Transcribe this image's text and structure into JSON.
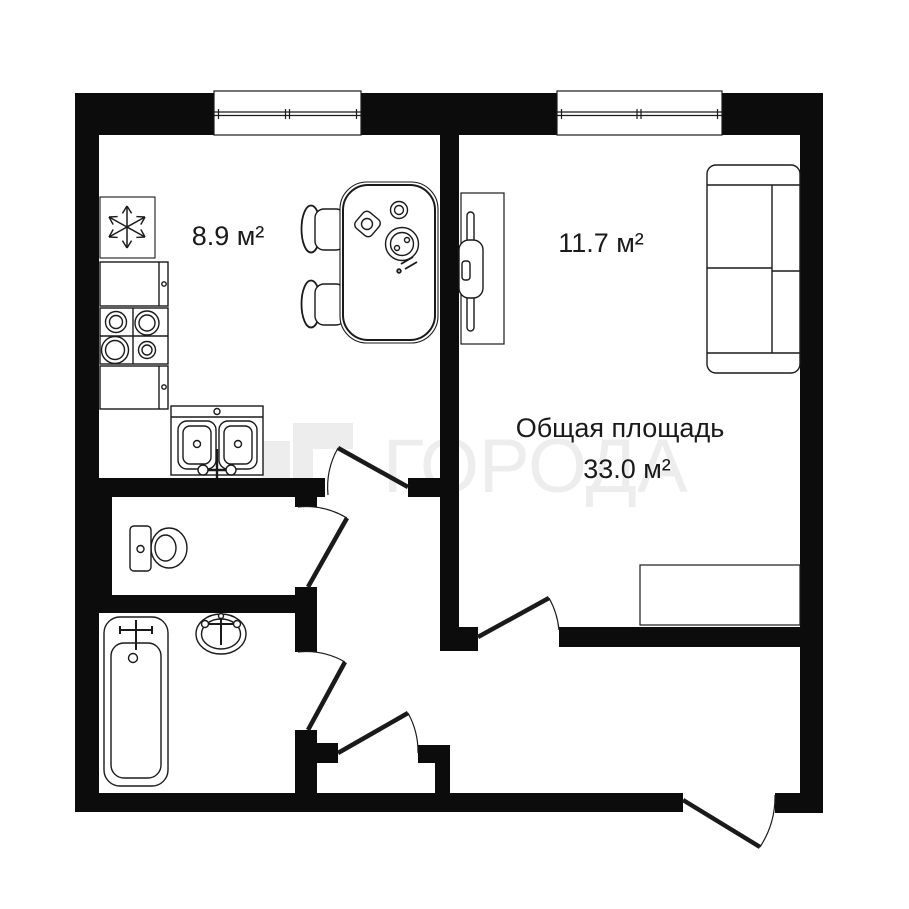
{
  "watermark": {
    "text": "ГОРОДА",
    "logo": "goroda-logo"
  },
  "rooms": {
    "kitchen": {
      "area": "8.9 м²"
    },
    "living_room": {
      "area": "11.7 м²"
    }
  },
  "total": {
    "label": "Общая площадь",
    "value": "33.0 м²"
  },
  "colors": {
    "background": "#ffffff",
    "wall": "#0c0c0c",
    "outline": "#1a1a1a",
    "watermark": "#ededed"
  },
  "fixtures": {
    "kitchen": [
      "fridge",
      "counter",
      "stove",
      "counter",
      "double-sink",
      "dining-table",
      "chair",
      "chair"
    ],
    "living_room": [
      "tv-stand",
      "sofa",
      "wardrobe"
    ],
    "wc": [
      "toilet"
    ],
    "bathroom": [
      "bathtub",
      "washbasin"
    ],
    "doors": [
      "kitchen-door",
      "wc-door",
      "bathroom-door",
      "closet-door",
      "living-room-door",
      "entrance-door"
    ],
    "windows": [
      "kitchen-window",
      "living-room-window"
    ]
  }
}
